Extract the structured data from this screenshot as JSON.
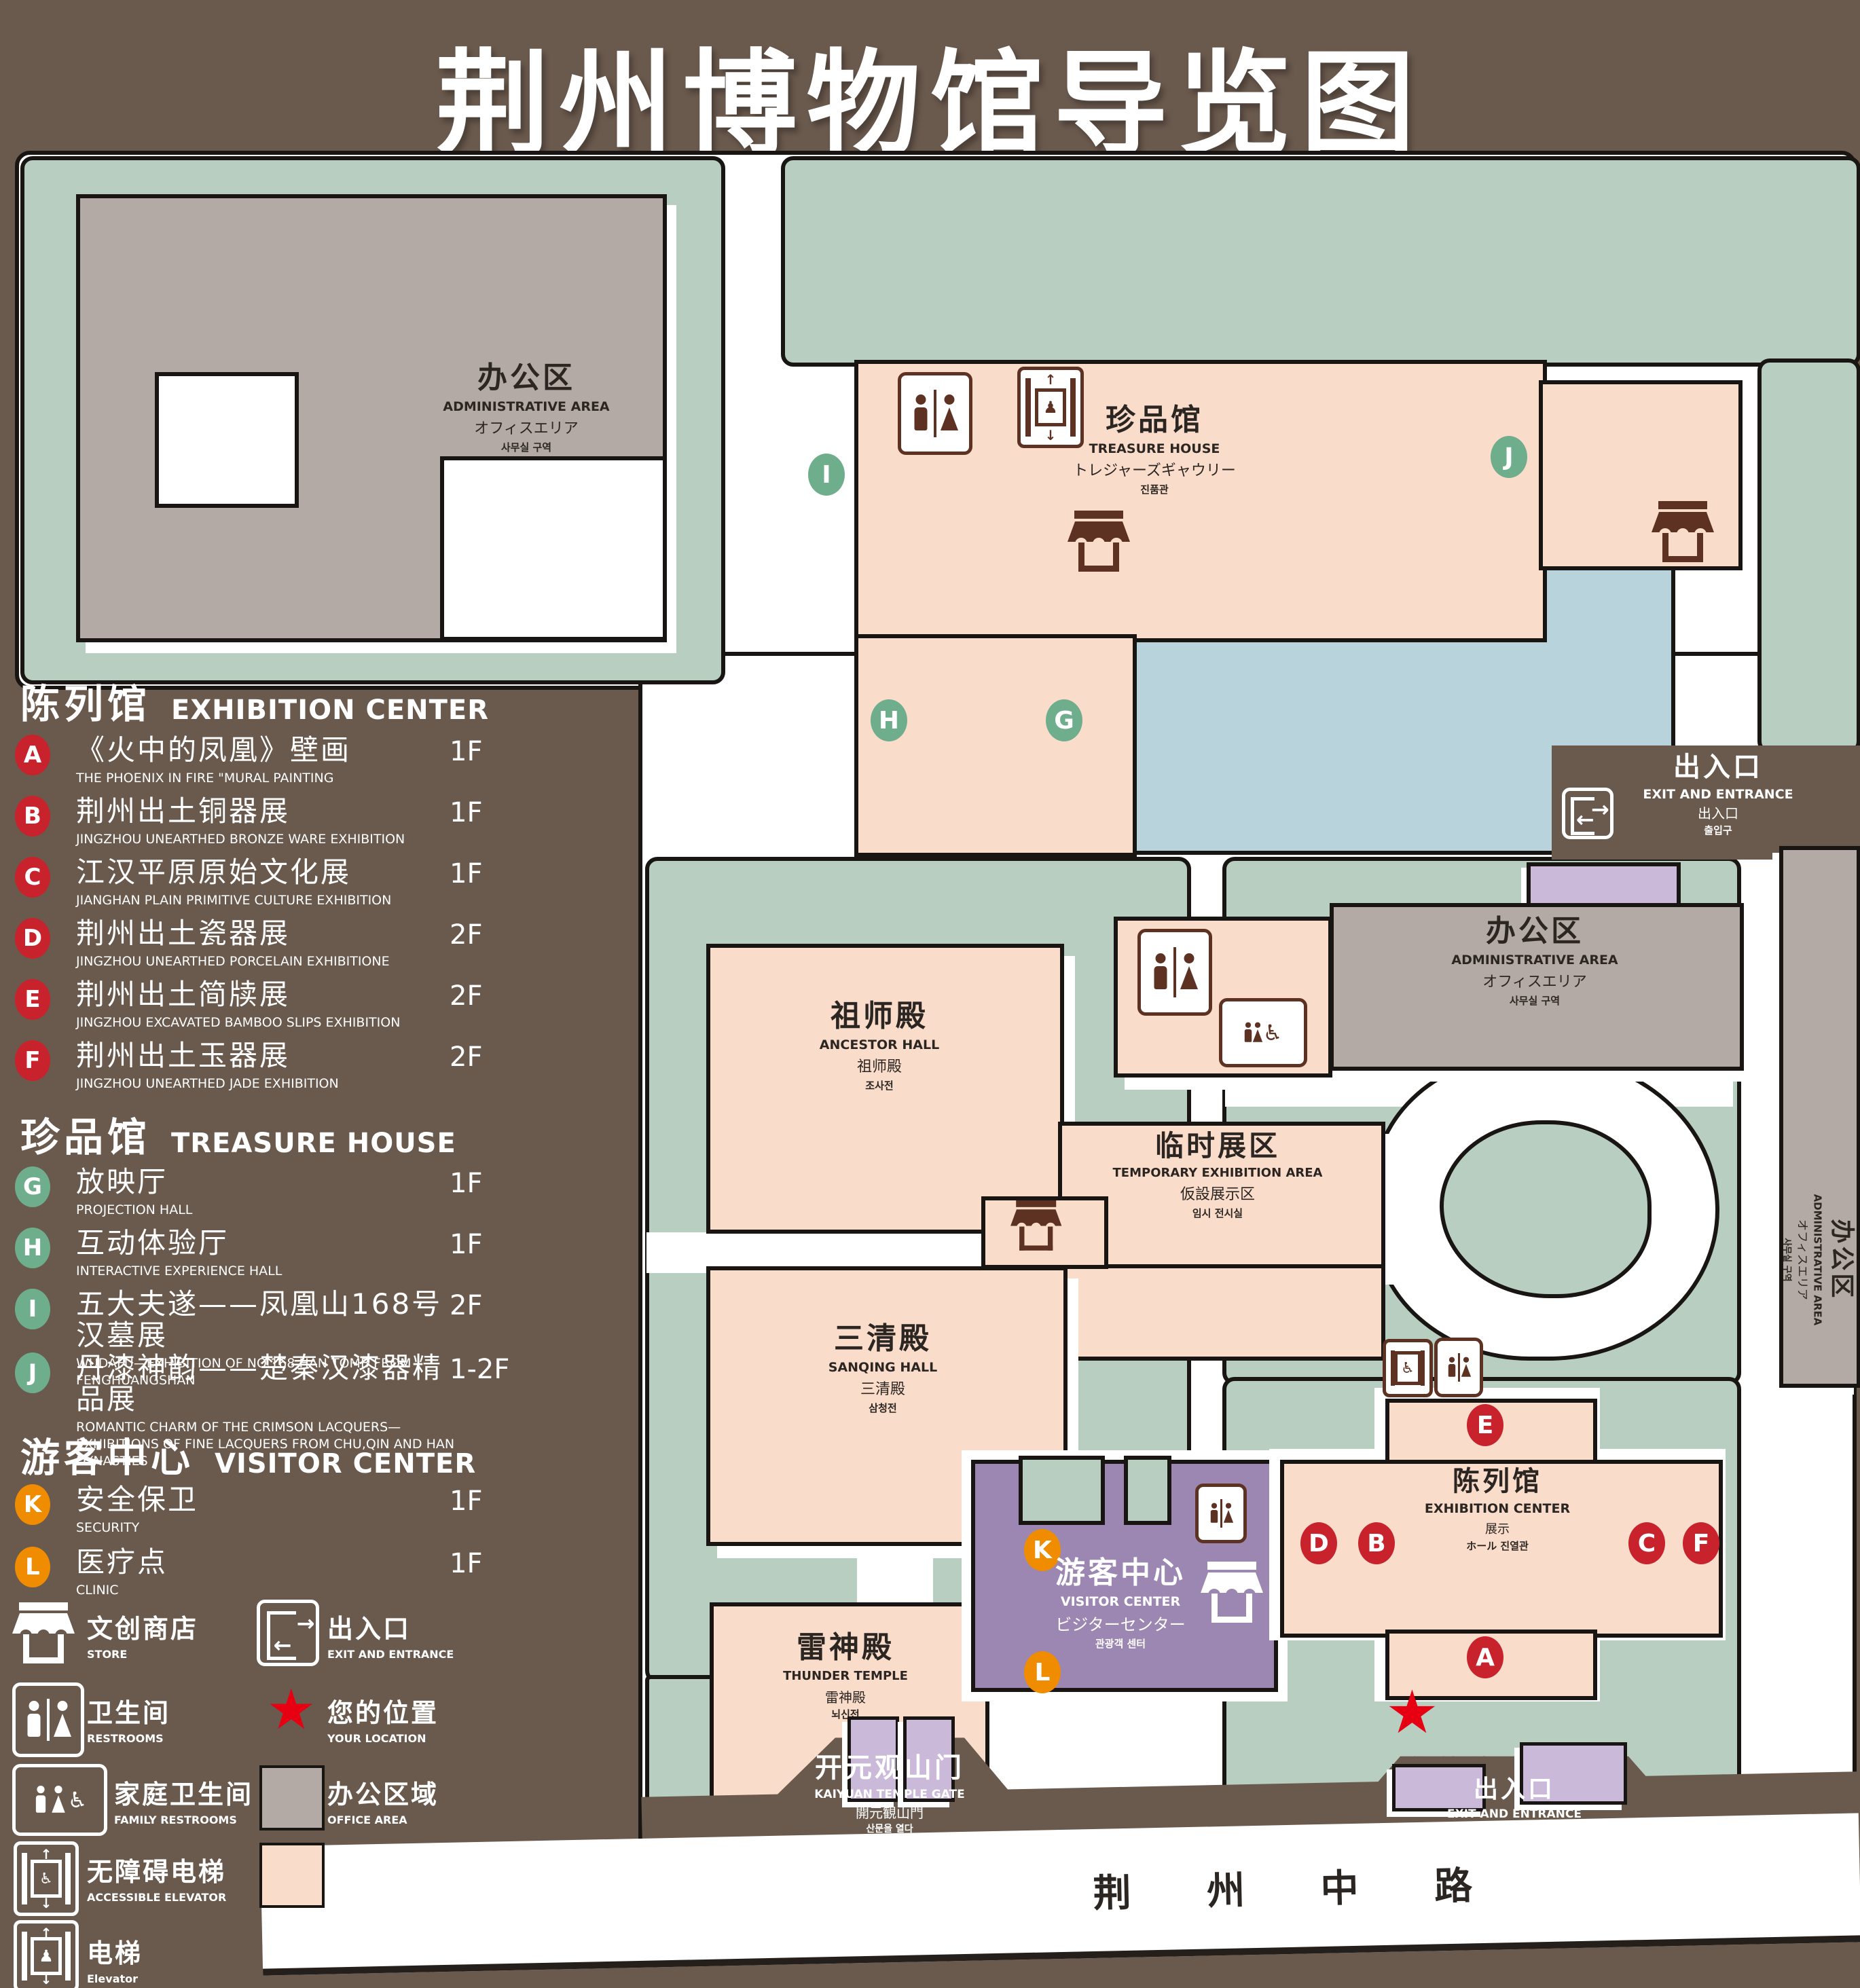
{
  "title": {
    "zh": "荆州博物馆导览图",
    "en": "GUIDE MAP OF JINGZHOU MUSEUM"
  },
  "legend_sections": [
    {
      "zh": "陈列馆",
      "en": "EXHIBITION CENTER",
      "badge_color": "#c8232c",
      "items": [
        {
          "letter": "A",
          "zh": "《火中的凤凰》壁画",
          "en": "THE PHOENIX IN FIRE \"MURAL PAINTING",
          "floor": "1F"
        },
        {
          "letter": "B",
          "zh": "荆州出土铜器展",
          "en": "JINGZHOU UNEARTHED BRONZE WARE EXHIBITION",
          "floor": "1F"
        },
        {
          "letter": "C",
          "zh": "江汉平原原始文化展",
          "en": "JIANGHAN PLAIN PRIMITIVE CULTURE EXHIBITION",
          "floor": "1F"
        },
        {
          "letter": "D",
          "zh": "荆州出土瓷器展",
          "en": "JINGZHOU UNEARTHED PORCELAIN EXHIBITIONE",
          "floor": "2F"
        },
        {
          "letter": "E",
          "zh": "荆州出土简牍展",
          "en": "JINGZHOU EXCAVATED BAMBOO SLIPS EXHIBITION",
          "floor": "2F"
        },
        {
          "letter": "F",
          "zh": "荆州出土玉器展",
          "en": "JINGZHOU UNEARTHED JADE EXHIBITION",
          "floor": "2F"
        }
      ]
    },
    {
      "zh": "珍品馆",
      "en": "TREASURE HOUSE",
      "badge_color": "#6fae8c",
      "items": [
        {
          "letter": "G",
          "zh": "放映厅",
          "en": "PROJECTION HALL",
          "floor": "1F"
        },
        {
          "letter": "H",
          "zh": "互动体验厅",
          "en": "INTERACTIVE EXPERIENCE HALL",
          "floor": "1F"
        },
        {
          "letter": "I",
          "zh": "五大夫遂——凤凰山168号汉墓展",
          "en": "WUDAFU—EXHIBITION OF NO.168 HAN TOMB FROM FENGHUANGSHAN",
          "floor": "2F"
        },
        {
          "letter": "J",
          "zh": "丹漆神韵——楚秦汉漆器精品展",
          "en": "ROMANTIC CHARM OF THE CRIMSON LACQUERS—EXHIBITIONS OF FINE LACQUERS FROM CHU,QIN AND HAN DYNASTIES",
          "floor": "1-2F"
        }
      ]
    },
    {
      "zh": "游客中心",
      "en": "VISITOR CENTER",
      "badge_color": "#f08c00",
      "items": [
        {
          "letter": "K",
          "zh": "安全保卫",
          "en": "SECURITY",
          "floor": "1F"
        },
        {
          "letter": "L",
          "zh": "医疗点",
          "en": "CLINIC",
          "floor": "1F"
        }
      ]
    }
  ],
  "legend_icons": {
    "store": {
      "zh": "文创商店",
      "en": "STORE"
    },
    "exit": {
      "zh": "出入口",
      "en": "EXIT AND ENTRANCE"
    },
    "restrooms": {
      "zh": "卫生间",
      "en": "RESTROOMS"
    },
    "your_location": {
      "zh": "您的位置",
      "en": "YOUR LOCATION"
    },
    "family_restrooms": {
      "zh": "家庭卫生间",
      "en": "FAMILY RESTROOMS"
    },
    "office_area": {
      "zh": "办公区域",
      "en": "OFFICE AREA"
    },
    "accessible_elevator": {
      "zh": "无障碍电梯",
      "en": "ACCESSIBLE ELEVATOR"
    },
    "display_area": {
      "zh": "展示区域",
      "en": "DISPLAY AREA"
    },
    "elevator": {
      "zh": "电梯",
      "en": "Elevator"
    }
  },
  "map": {
    "admin_top_left": {
      "zh": "办公区",
      "en": "ADMINISTRATIVE AREA",
      "ja": "オフィスエリア",
      "ko": "사무실 구역"
    },
    "admin_center_right": {
      "zh": "办公区",
      "en": "ADMINISTRATIVE AREA",
      "ja": "オフィスエリア",
      "ko": "사무실 구역"
    },
    "admin_right_strip": {
      "zh": "办公区",
      "en": "ADMINISTRATIVE AREA",
      "ja": "オフィスエリア",
      "ko": "사무실 구역"
    },
    "treasure_house": {
      "zh": "珍品馆",
      "en": "TREASURE HOUSE",
      "ja": "トレジャーズギャウリー",
      "ko": "진품관"
    },
    "ancestor_hall": {
      "zh": "祖师殿",
      "en": "ANCESTOR HALL",
      "ja": "祖师殿",
      "ko": "조사전"
    },
    "temporary_exhibition": {
      "zh": "临时展区",
      "en": "TEMPORARY EXHIBITION AREA",
      "ja": "仮設展示区",
      "ko": "임시 전시실"
    },
    "sanqing_hall": {
      "zh": "三清殿",
      "en": "SANQING HALL",
      "ja": "三清殿",
      "ko": "삼청전"
    },
    "thunder_temple": {
      "zh": "雷神殿",
      "en": "THUNDER TEMPLE",
      "ja": "雷神殿",
      "ko": "뇌신전"
    },
    "visitor_center": {
      "zh": "游客中心",
      "en": "VISITOR CENTER",
      "ja": "ビジターセンター",
      "ko": "관광객 센터"
    },
    "exhibition_center": {
      "zh": "陈列馆",
      "en": "EXHIBITION CENTER",
      "ja": "展示",
      "ko": "ホール 진열관"
    },
    "kaiyuan_gate": {
      "zh": "开元观山门",
      "en": "KAIYUAN TEMPLE GATE",
      "ja": "開元観山門",
      "ko": "산문을 열다"
    },
    "exit_top_right": {
      "zh": "出入口",
      "en": "EXIT AND ENTRANCE",
      "ja": "出入口",
      "ko": "출입구"
    },
    "exit_bottom": {
      "zh": "出入口",
      "en": "EXIT AND ENTRANCE",
      "ja": "出入口",
      "ko": "출입구"
    },
    "your_location": "您的位置",
    "road": "荆 州 中 路",
    "markers": {
      "a": "A",
      "b": "B",
      "c": "C",
      "d": "D",
      "e": "E",
      "f": "F",
      "g": "G",
      "h": "H",
      "i": "I",
      "j": "J",
      "k": "K",
      "l": "L"
    }
  },
  "colors": {
    "background": "#6a594d",
    "display_area": "#fadccb",
    "office_area": "#b3aaa5",
    "green_space": "#b7cec1",
    "visitor_center": "#9c86b2",
    "light_purple": "#cbb9da",
    "pond": "#b9d3dd",
    "badge_red": "#c8232c",
    "badge_green": "#6fae8c",
    "badge_orange": "#f08c00",
    "location_red": "#e60012",
    "icon_brown": "#5d3222"
  }
}
